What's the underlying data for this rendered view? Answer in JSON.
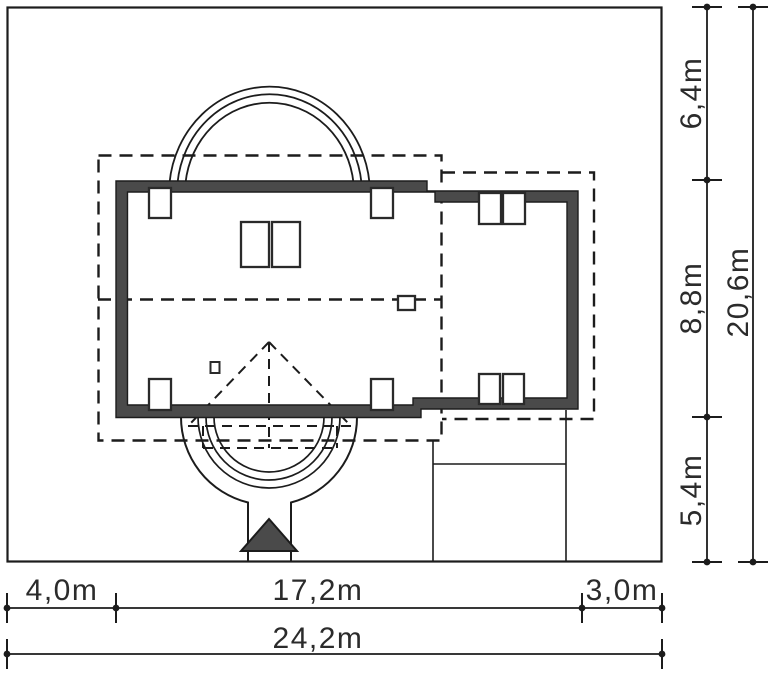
{
  "dims": {
    "bottom_segments": [
      {
        "label": "4,0m",
        "value": 4.0
      },
      {
        "label": "17,2m",
        "value": 17.2
      },
      {
        "label": "3,0m",
        "value": 3.0
      }
    ],
    "bottom_total": {
      "label": "24,2m",
      "value": 24.2
    },
    "right_segments": [
      {
        "label": "6,4m",
        "value": 6.4
      },
      {
        "label": "8,8m",
        "value": 8.8
      },
      {
        "label": "5,4m",
        "value": 5.4
      }
    ],
    "right_total": {
      "label": "20,6m",
      "value": 20.6
    }
  },
  "colors": {
    "wall_fill": "#4a4a4a",
    "line": "#1c1c1c",
    "background": "#ffffff"
  }
}
